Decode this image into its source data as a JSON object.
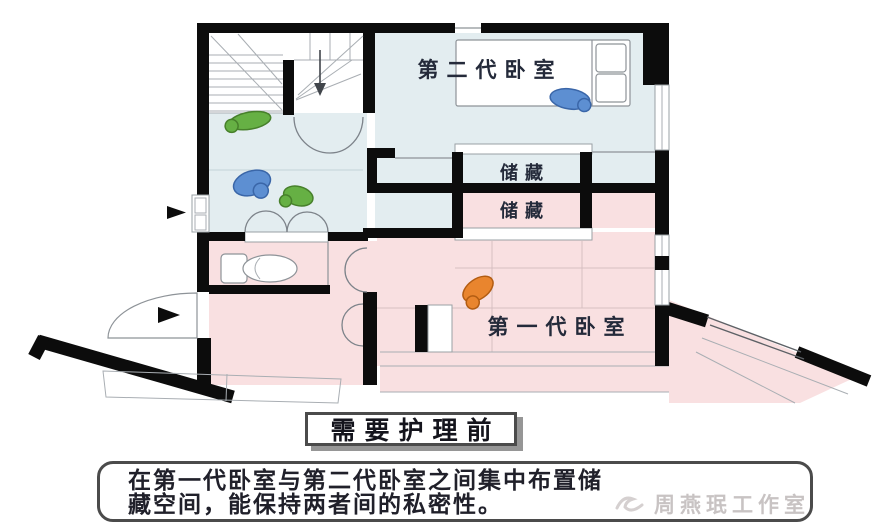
{
  "plan": {
    "labels": {
      "bedroom2": "第二代卧室",
      "storage_top": "储藏",
      "storage_bottom": "储藏",
      "bedroom1": "第一代卧室"
    },
    "colors": {
      "floor_blue": "#e3edf0",
      "floor_pink": "#f9e0e1",
      "wall_black": "#0c0c0c",
      "figure_green": "#66b044",
      "figure_blue": "#5d8fd2",
      "figure_orange": "#e9852e",
      "room_label_text": "#242a3a"
    }
  },
  "caption": {
    "title": "需要护理前",
    "description_line1": "在第一代卧室与第二代卧室之间集中布置储",
    "description_line2": "藏空间，能保持两者间的私密性。"
  },
  "watermark": {
    "text": "周燕珉工作室"
  }
}
